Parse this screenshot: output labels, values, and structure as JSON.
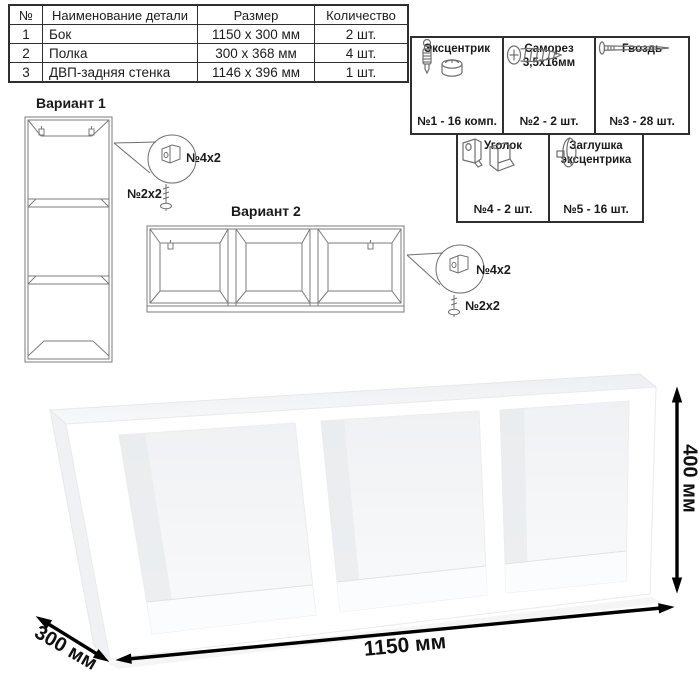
{
  "parts_table": {
    "headers": [
      "№",
      "Наименование детали",
      "Размер",
      "Количество"
    ],
    "rows": [
      {
        "num": "1",
        "name": "Бок",
        "size": "1150 x 300 мм",
        "qty": "2 шт."
      },
      {
        "num": "2",
        "name": "Полка",
        "size": "300 x 368 мм",
        "qty": "4 шт."
      },
      {
        "num": "3",
        "name": "ДВП-задняя стенка",
        "size": "1146 x 396 мм",
        "qty": "1 шт."
      }
    ]
  },
  "hardware_box": {
    "items": [
      {
        "name": "Эксцентрик",
        "icon": "eccentric-cam-icon",
        "count": "№1 - 16 комп."
      },
      {
        "name": "Саморез 3,5х16мм",
        "icon": "screw-icon",
        "count": "№2 - 2 шт."
      },
      {
        "name": "Гвоздь",
        "icon": "nail-icon",
        "count": "№3 - 28 шт."
      },
      {
        "name": "Уголок",
        "icon": "corner-bracket-icon",
        "count": "№4 - 2 шт."
      },
      {
        "name": "Заглушка эксцентрика",
        "icon": "cam-cap-icon",
        "count": "№5 - 16 шт."
      }
    ]
  },
  "variants": {
    "v1": {
      "title": "Вариант 1",
      "bracket_label": "№4х2",
      "screw_label": "№2х2"
    },
    "v2": {
      "title": "Вариант 2",
      "bracket_label": "№4х2",
      "screw_label": "№2х2"
    }
  },
  "dimensions": {
    "width": "1150 мм",
    "depth": "300 мм",
    "height": "400 мм"
  },
  "colors": {
    "line_art": "#7b7b7b",
    "border": "#2f2f2f",
    "arrow": "#000000"
  }
}
